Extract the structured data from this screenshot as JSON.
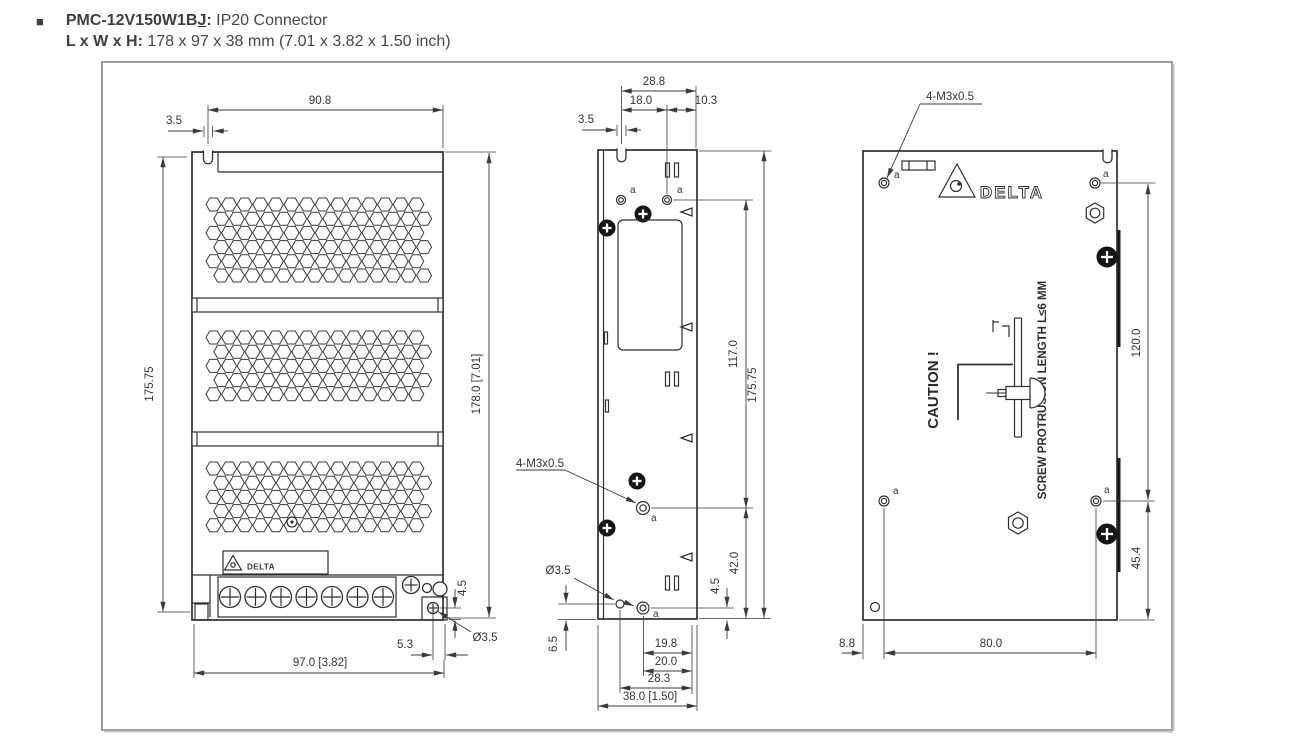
{
  "header": {
    "bullet": "■",
    "model": "PMC-12V150W1B",
    "model_suffix": "J",
    "colon": ":",
    "subtitle": " IP20 Connector",
    "size_label": "L x W x H: ",
    "size_value": "178 x 97 x 38 mm (7.01 x 3.82 x 1.50 inch)"
  },
  "brand": {
    "wordmark": "DELTA",
    "plate_wordmark": "DELTA"
  },
  "front_view": {
    "dim_top_width": "90.8",
    "dim_notch_width": "3.5",
    "dim_height_left": "175.75",
    "dim_height_right": "178.0 [7.01]",
    "dim_ear_height": "4.5",
    "dim_hole_dia": "Ø3.5",
    "dim_hole_offset": "5.3",
    "dim_bottom_width": "97.0 [3.82]"
  },
  "side_view": {
    "dim_depth_total": "28.8",
    "dim_hole_offset_x": "18.0",
    "dim_edge_offset": "10.3",
    "dim_notch_width": "3.5",
    "callout_mounting_holes": "4-M3x0.5",
    "hole_label": "a",
    "dim_hole_to_hole": "117.0",
    "dim_height_total": "175.75",
    "dim_hole_to_bottom": "42.0",
    "dim_ear_height": "4.5",
    "dim_hole_dia": "Ø3.5",
    "dim_bottom_hole_y": "6.5",
    "dim_b1": "19.8",
    "dim_b2": "20.0",
    "dim_b3": "28.3",
    "dim_b4": "38.0 [1.50]"
  },
  "back_view": {
    "callout_mounting_holes": "4-M3x0.5",
    "hole_label": "a",
    "caution_title": "CAUTION !",
    "caution_note": "SCREW PROTRUSION LENGTH  L≤6 MM",
    "dim_hole_span_y": "120.0",
    "dim_hole_to_bottom": "45.4",
    "dim_edge_to_hole_x": "8.8",
    "dim_hole_span_x": "80.0"
  }
}
